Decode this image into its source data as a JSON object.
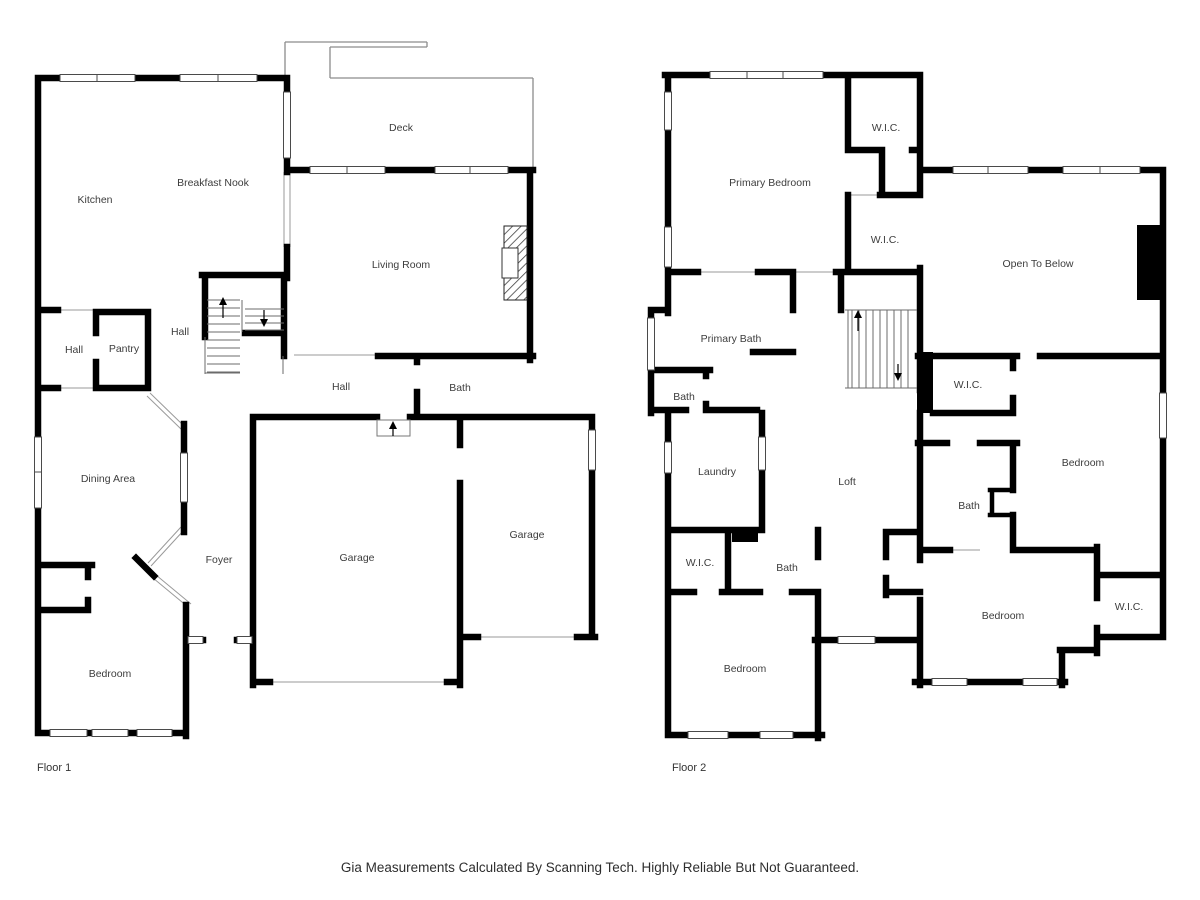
{
  "footer": {
    "disclaimer": "Gia Measurements Calculated By Scanning Tech. Highly Reliable But Not Guaranteed."
  },
  "colors": {
    "background": "#ffffff",
    "wall": "#000000",
    "label": "#3d3d3d",
    "thin_line": "#8c8c8c"
  },
  "floor1": {
    "name": "Floor 1",
    "name_pos": {
      "x": 37,
      "y": 771
    },
    "rooms": [
      {
        "label": "Deck",
        "x": 401,
        "y": 131
      },
      {
        "label": "Kitchen",
        "x": 95,
        "y": 203
      },
      {
        "label": "Breakfast Nook",
        "x": 213,
        "y": 186
      },
      {
        "label": "Living Room",
        "x": 401,
        "y": 268
      },
      {
        "label": "Hall",
        "x": 180,
        "y": 335
      },
      {
        "label": "Hall",
        "x": 74,
        "y": 353
      },
      {
        "label": "Pantry",
        "x": 124,
        "y": 352
      },
      {
        "label": "Hall",
        "x": 341,
        "y": 390
      },
      {
        "label": "Bath",
        "x": 460,
        "y": 391
      },
      {
        "label": "Dining Area",
        "x": 108,
        "y": 482
      },
      {
        "label": "Foyer",
        "x": 219,
        "y": 563
      },
      {
        "label": "Garage",
        "x": 357,
        "y": 561
      },
      {
        "label": "Garage",
        "x": 527,
        "y": 538
      },
      {
        "label": "Bedroom",
        "x": 110,
        "y": 677
      }
    ]
  },
  "floor2": {
    "name": "Floor 2",
    "name_pos": {
      "x": 672,
      "y": 771
    },
    "rooms": [
      {
        "label": "W.I.C.",
        "x": 886,
        "y": 131
      },
      {
        "label": "Primary Bedroom",
        "x": 770,
        "y": 186
      },
      {
        "label": "W.I.C.",
        "x": 885,
        "y": 243
      },
      {
        "label": "Open To Below",
        "x": 1038,
        "y": 267
      },
      {
        "label": "Primary Bath",
        "x": 731,
        "y": 342
      },
      {
        "label": "Bath",
        "x": 684,
        "y": 400
      },
      {
        "label": "W.I.C.",
        "x": 968,
        "y": 388
      },
      {
        "label": "Laundry",
        "x": 717,
        "y": 475
      },
      {
        "label": "Loft",
        "x": 847,
        "y": 485
      },
      {
        "label": "Bedroom",
        "x": 1083,
        "y": 466
      },
      {
        "label": "Bath",
        "x": 969,
        "y": 509
      },
      {
        "label": "W.I.C.",
        "x": 700,
        "y": 566
      },
      {
        "label": "Bath",
        "x": 787,
        "y": 571
      },
      {
        "label": "Bedroom",
        "x": 745,
        "y": 672
      },
      {
        "label": "Bedroom",
        "x": 1003,
        "y": 619
      },
      {
        "label": "W.I.C.",
        "x": 1129,
        "y": 610
      }
    ]
  }
}
